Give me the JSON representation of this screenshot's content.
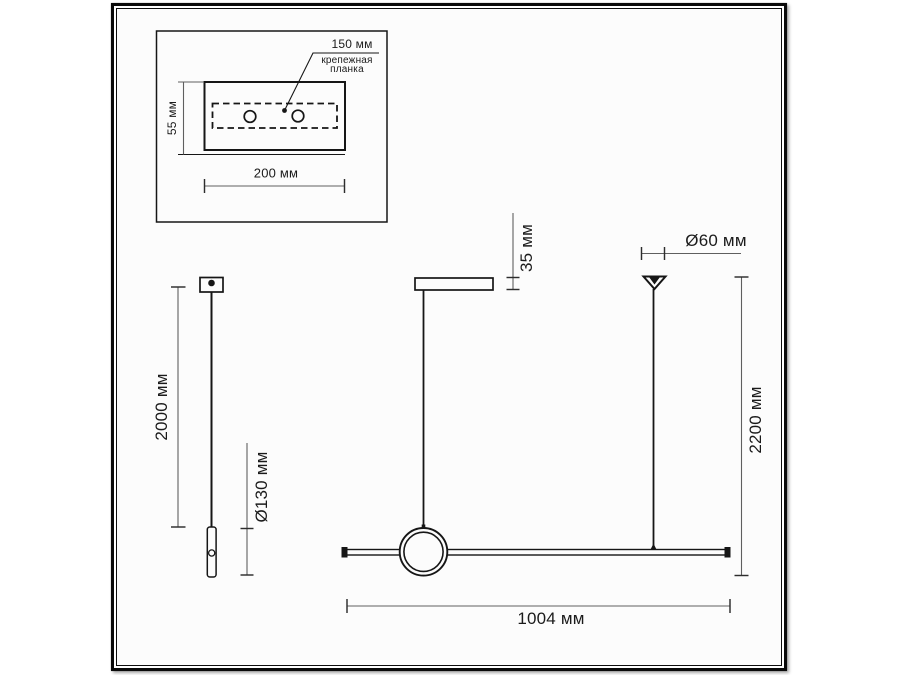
{
  "document": {
    "type": "technical dimension drawing",
    "subject": "linear pendant light fixture",
    "language": "ru",
    "units": "мм"
  },
  "colors": {
    "ink": "#161616",
    "dimension_line": "#5f5f5f",
    "paper": "#fcfcfc",
    "frame": "#0a0a0a",
    "page_background": "#ffffff"
  },
  "mounting_plate_inset": {
    "hole_spacing_label": "150 мм",
    "part_label": "крепежная планка",
    "height_label": "55 мм",
    "width_label": "200 мм"
  },
  "cable_side_view": {
    "cable_length_label": "2000 мм",
    "grip_length_label": "Ø130 мм"
  },
  "fixture_front_view": {
    "canopy_height_label": "35 мм",
    "bar_length_label": "1004 мм"
  },
  "overall_dimensions": {
    "canopy_diameter_label": "Ø60 мм",
    "overall_height_label": "2200 мм"
  }
}
